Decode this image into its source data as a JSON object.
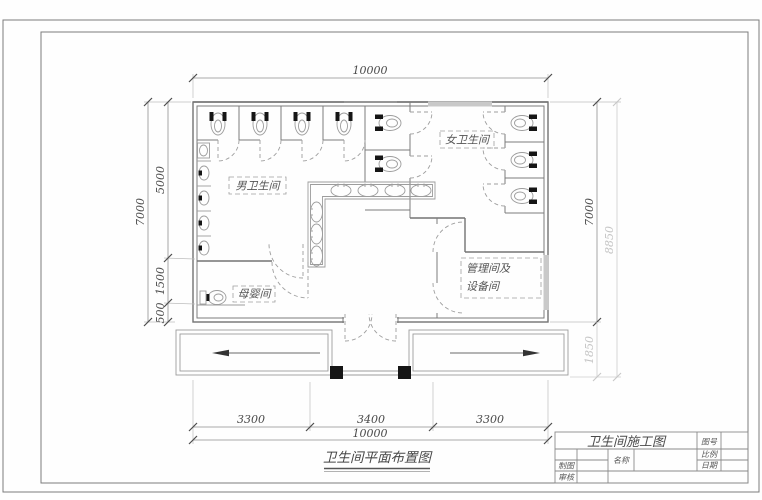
{
  "sheet": {
    "plan_title": "卫生间平面布置图",
    "dimensions": {
      "top_total": "10000",
      "left_total": "7000",
      "left_seg_5000": "5000",
      "left_seg_1500": "1500",
      "left_seg_500": "500",
      "right_total": "7000",
      "right_overall": "8850",
      "right_porch": "1850",
      "bottom_seg_left": "3300",
      "bottom_seg_mid": "3400",
      "bottom_seg_right": "3300",
      "bottom_total": "10000"
    },
    "rooms": {
      "mens": "男卫生间",
      "womens": "女卫生间",
      "nursing": "母婴间",
      "management_line1": "管理间及",
      "management_line2": "设备间"
    },
    "title_block": {
      "project_title": "卫生间施工图",
      "drawing_no_label": "图号",
      "scale_label": "比例",
      "date_label": "日期",
      "name_label": "名称",
      "drafter_label": "制图",
      "reviewer_label": "审核"
    }
  }
}
